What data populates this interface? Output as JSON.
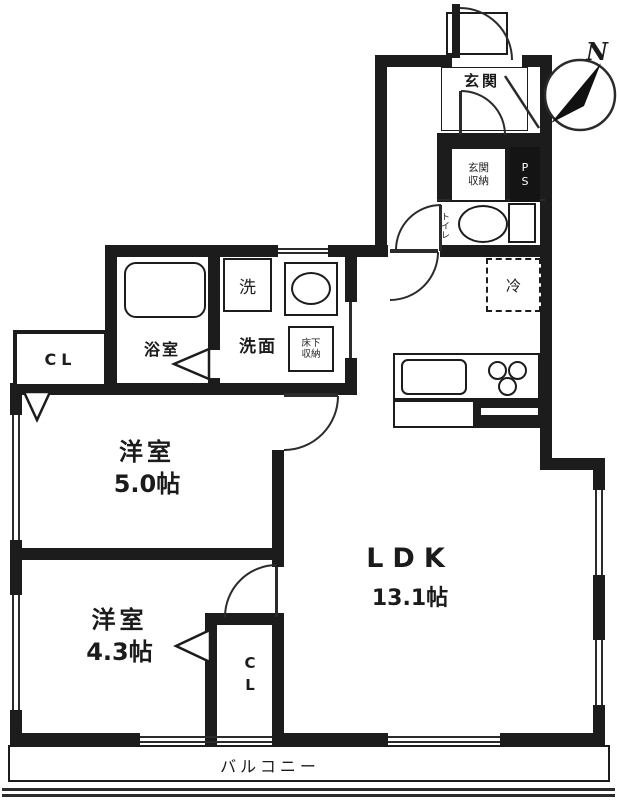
{
  "meta": {
    "type": "floor-plan"
  },
  "compass": {
    "label": "N"
  },
  "colors": {
    "wall": "#1c1c1c",
    "background": "#ffffff",
    "line": "#2b2b2b"
  },
  "rooms": {
    "entrance": {
      "label": "玄関"
    },
    "entrance_storage": {
      "line1": "玄関",
      "line2": "収納"
    },
    "pipe_space": {
      "label": "PS"
    },
    "toilet": {
      "label": "トイレ"
    },
    "refrigerator": {
      "label": "冷"
    },
    "laundry": {
      "label": "洗"
    },
    "bathroom": {
      "label": "浴室"
    },
    "washroom": {
      "label": "洗面"
    },
    "underfloor_storage": {
      "line1": "床下",
      "line2": "収納"
    },
    "closet1": {
      "label": "CL"
    },
    "closet2": {
      "label": "CL"
    },
    "western_room_1": {
      "name": "洋室",
      "size": "5.0帖"
    },
    "western_room_2": {
      "name": "洋室",
      "size": "4.3帖"
    },
    "ldk": {
      "name": "LDK",
      "size": "13.1帖"
    },
    "balcony": {
      "label": "バルコニー"
    }
  }
}
